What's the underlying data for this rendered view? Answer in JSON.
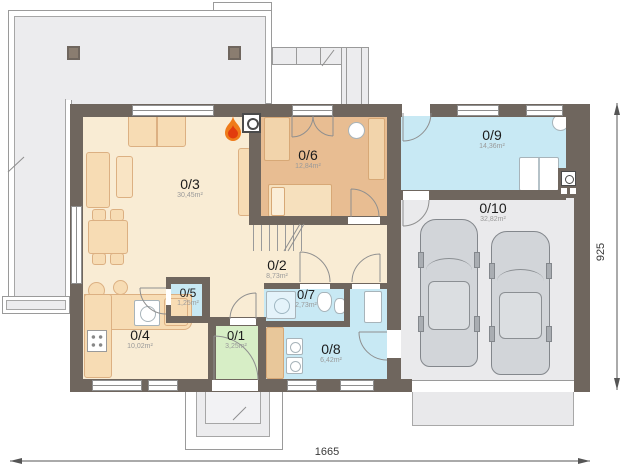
{
  "rooms": [
    {
      "number": "0/1",
      "area": "3,25m²"
    },
    {
      "number": "0/2",
      "area": "8,73m²"
    },
    {
      "number": "0/3",
      "area": "30,45m²"
    },
    {
      "number": "0/4",
      "area": "10,02m²"
    },
    {
      "number": "0/5",
      "area": "1,25m²"
    },
    {
      "number": "0/6",
      "area": "12,84m²"
    },
    {
      "number": "0/7",
      "area": "2,73m²"
    },
    {
      "number": "0/8",
      "area": "6,42m²"
    },
    {
      "number": "0/9",
      "area": "14,36m²"
    },
    {
      "number": "0/10",
      "area": "32,82m²"
    }
  ],
  "dimensions": {
    "width": "1665",
    "height": "925"
  },
  "icons": {
    "fireplace": "flame-icon"
  },
  "palette": {
    "wall": "#6f665e",
    "room_cream": "#f9ecd4",
    "room_tan": "#e8bd92",
    "room_blue": "#c8e9f4",
    "room_green": "#d7eec6",
    "garage_floor": "#eaeaec",
    "terrace": "#ececee",
    "flame_orange": "#ef7b1a",
    "flame_red": "#e23b0e"
  }
}
